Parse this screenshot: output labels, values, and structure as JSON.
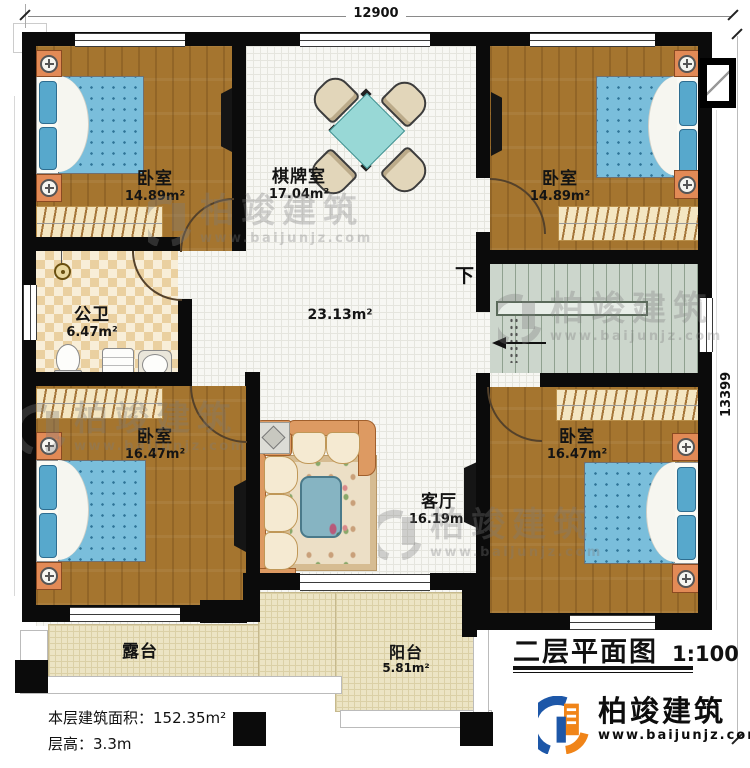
{
  "plan": {
    "title": "二层平面图",
    "scale": "1:100",
    "dimensions": {
      "top": "12900",
      "right": "13399"
    },
    "stairs": {
      "direction": "下"
    },
    "notes": {
      "floor_area_label": "本层建筑面积：",
      "floor_area_value": "152.35m²",
      "floor_height_label": "层高：",
      "floor_height_value": "3.3m"
    }
  },
  "rooms": {
    "bedroom_tl": {
      "name": "卧室",
      "area": "14.89m²"
    },
    "game_room": {
      "name": "棋牌室",
      "area": "17.04m²"
    },
    "bedroom_tr": {
      "name": "卧室",
      "area": "14.89m²"
    },
    "bathroom": {
      "name": "公卫",
      "area": "6.47m²"
    },
    "hall": {
      "area": "23.13m²"
    },
    "bedroom_bl": {
      "name": "卧室",
      "area": "16.47m²"
    },
    "living_room": {
      "name": "客厅",
      "area": "16.19m²"
    },
    "bedroom_br": {
      "name": "卧室",
      "area": "16.47m²"
    },
    "terrace": {
      "name": "露台"
    },
    "balcony": {
      "name": "阳台",
      "area": "5.81m²"
    }
  },
  "brand": {
    "name": "柏竣建筑",
    "website": "www.baijunjz.com",
    "colors": {
      "blue": "#1d57a8",
      "orange": "#f08418"
    }
  },
  "watermark": {
    "name": "柏竣建筑",
    "website": "www.baijunjz.com"
  }
}
